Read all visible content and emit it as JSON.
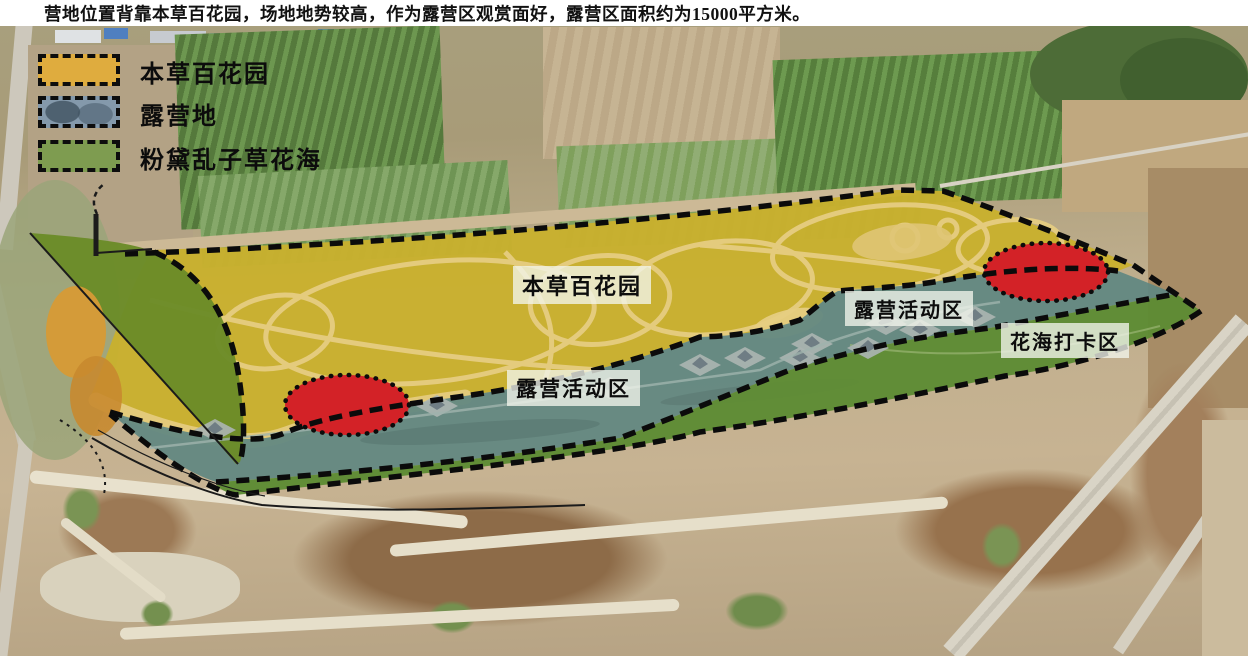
{
  "title": "营地位置背靠本草百花园，场地地势较高，作为露营区观赏面好，露营区面积约为15000平方米。",
  "legend": {
    "items": [
      {
        "label": "本草百花园",
        "color": "#dfac3e"
      },
      {
        "label": "露营地",
        "color": "#8499ab"
      },
      {
        "label": "粉黛乱子草花海",
        "color": "#7e9c50"
      }
    ]
  },
  "map": {
    "region_labels": {
      "herb_garden": "本草百花园",
      "camping_left": "露营活动区",
      "camping_right": "露营活动区",
      "flower_checkin": "花海打卡区"
    },
    "colors": {
      "herb_garden": "#c9b02e",
      "herb_garden_path": "#e6cd82",
      "camping": "#5f8781",
      "flower_sea": "#5c8b33",
      "flower_patch": "#6b8b28",
      "highlight_red": "#d32227",
      "boundary": "#0b0b0b"
    },
    "campsite_pad_count": 11,
    "highlight_ellipse_count": 2
  }
}
